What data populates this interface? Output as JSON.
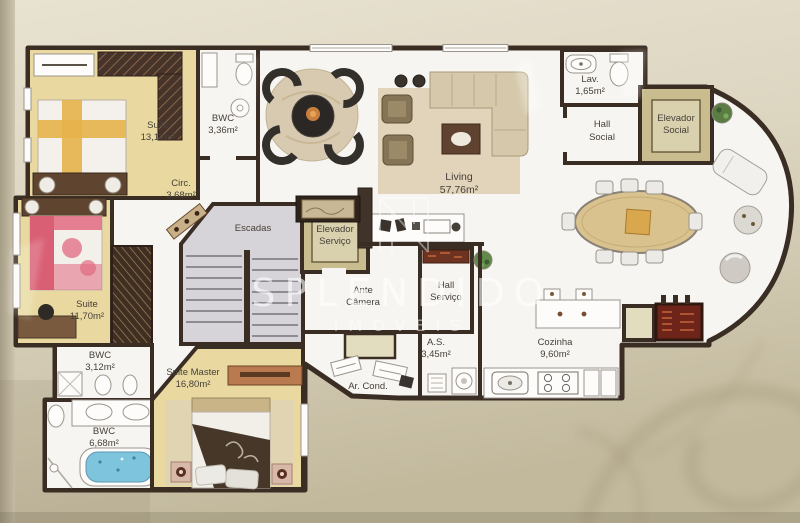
{
  "watermark": {
    "brand": "SPLENDIDO",
    "subtitle": "IMÓVEIS"
  },
  "rooms": {
    "suite_1": {
      "name": "Suite",
      "area": "13,14m²"
    },
    "bwc_1": {
      "name": "BWC",
      "area": "3,36m²"
    },
    "circ": {
      "name": "Circ.",
      "area": "3,68m²"
    },
    "escadas": {
      "name": "Escadas"
    },
    "elevador_servico": {
      "line1": "Elevador",
      "line2": "Serviço"
    },
    "living": {
      "name": "Living",
      "area": "57,76m²"
    },
    "lav": {
      "name": "Lav.",
      "area": "1,65m²"
    },
    "hall_social": {
      "line1": "Hall",
      "line2": "Social"
    },
    "elevador_social": {
      "line1": "Elevador",
      "line2": "Social"
    },
    "suite_2": {
      "name": "Suite",
      "area": "11,70m²"
    },
    "bwc_2": {
      "name": "BWC",
      "area": "3,12m²"
    },
    "suite_master": {
      "name": "Suite Master",
      "area": "16,80m²"
    },
    "bwc_3": {
      "name": "BWC",
      "area": "6,68m²"
    },
    "ante_camera": {
      "line1": "Ante",
      "line2": "Câmera"
    },
    "hall_servico": {
      "line1": "Hall",
      "line2": "Serviço"
    },
    "area_servico": {
      "name": "A.S.",
      "area": "3,45m²"
    },
    "ar_cond": {
      "name": "Ar. Cond."
    },
    "cozinha": {
      "name": "Cozinha",
      "area": "9,60m²"
    }
  },
  "colors": {
    "wall": "#3a2d23",
    "bedroom_floor": "#e9d9a0",
    "plan_floor": "#f7f5f1",
    "background": "#d9d2bd",
    "bathtub": "#7fc4dd",
    "accent_bed_pink": "#e06a80",
    "accent_bed_yellow": "#e5b34a",
    "grill_red": "#6e2418"
  }
}
